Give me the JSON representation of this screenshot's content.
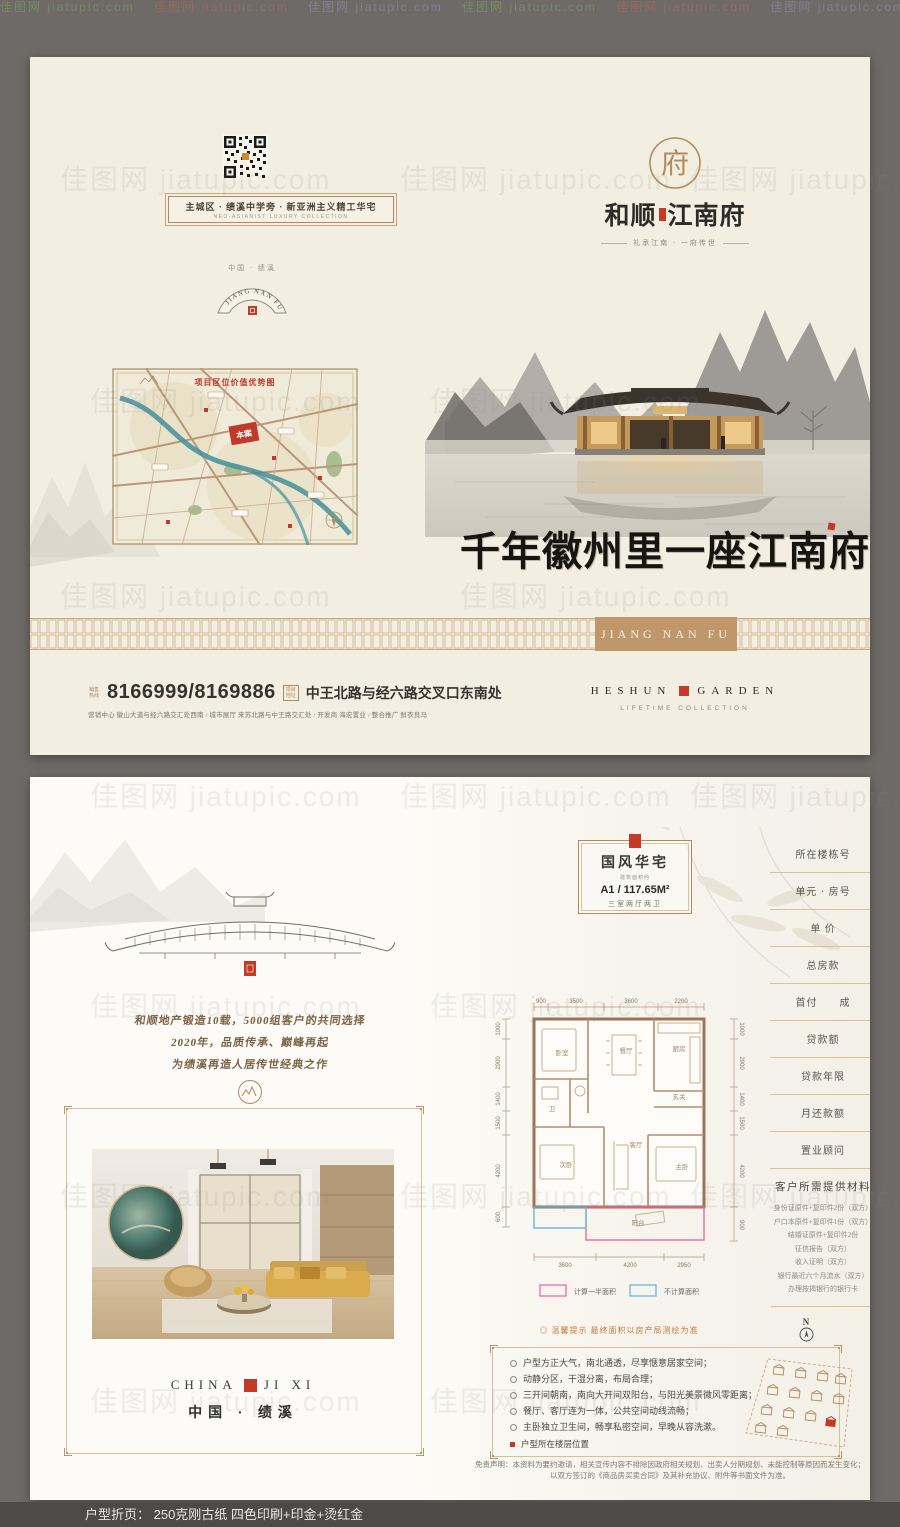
{
  "page": {
    "watermark": "佳图网 jiatupic.com",
    "watermark_row": "佳图网 jiatupic.com  佳图网 jiatupic.com  佳图网 jiatupic.com  佳图网 jiatupic.com  佳图网 jiatupic.com",
    "caption": "户型折页： 250克刚古纸   四色印刷+印金+烫红金"
  },
  "colors": {
    "accent_gold": "#b08a5f",
    "seal_red": "#c23a28",
    "band_tan": "#c0976b",
    "river_teal": "#43909b",
    "legend_pink": "#e8649a",
    "legend_blue": "#5ab4d8"
  },
  "cover": {
    "banner": {
      "title": "主城区 · 绩溪中学旁 · 新亚洲主义精工华宅",
      "subtitle": "NEO-ASIANIST LUXURY COLLECTION"
    },
    "country_label": "中国 · 绩溪",
    "fan_label": "JIANG NAN FU",
    "map": {
      "title": "项目区位价值优势图",
      "site_label": "本案"
    },
    "logo": {
      "name_left": "和顺",
      "name_right": "江南府",
      "tagline": "礼承江南 · 一府传世"
    },
    "calligraphy": "千年徽州里一座江南府",
    "band_label": "JIANG NAN FU",
    "contact": {
      "hotline_icon_text": "销售热线",
      "phones": "8166999/8169886",
      "address_icon_text": "项目地址",
      "address": "中王北路与经六路交叉口东南处",
      "agencies": "营销中心 徽山大道与经六路交汇处西南 / 城市展厅 来苏北路与中王路交汇处 / 开发商 海宏置业 / 整合推广 鲜衣良马"
    },
    "brand": {
      "en_left": "HESHUN",
      "en_right": "GARDEN",
      "subtitle": "LIFETIME COLLECTION"
    }
  },
  "inside": {
    "left": {
      "intro_lines": [
        "和顺地产锻造10载，5000组客户的共同选择",
        "2020年，品质传承、巅峰再起",
        "为绩溪再造人居传世经典之作"
      ],
      "china_en_left": "CHINA",
      "china_en_right": "JI XI",
      "china_cn": "中国 · 绩溪"
    },
    "right": {
      "unit_card": {
        "title": "国风华宅",
        "subtitle": "建筑面积约",
        "unit": "A1 / 117.65M²",
        "rooms": "三室两厅两卫"
      },
      "form_fields": [
        "所在楼栋号",
        "单元 · 房号",
        "单 价",
        "总房款",
        "首付　　成",
        "贷款额",
        "贷款年限",
        "月还款额",
        "置业顾问"
      ],
      "materials": {
        "title": "客户所需提供材料",
        "items": [
          "身份证原件+复印件2份（双方）",
          "户口本原件+复印件1份（双方）",
          "结婚证原件+复印件2份",
          "征信报告（双方）",
          "收入证明（双方）",
          "银行最近六个月流水（双方）",
          "办理按揭银行的银行卡"
        ]
      },
      "floorplan": {
        "dims_top": [
          "900",
          "3500",
          "3600",
          "2200"
        ],
        "dims_left": [
          "1000",
          "2900",
          "1400",
          "1500",
          "4200",
          "600"
        ],
        "dims_right": [
          "1000",
          "2900",
          "1400",
          "1500",
          "4200",
          "900"
        ],
        "dims_bottom": [
          "3600",
          "4200",
          "2950"
        ],
        "rooms": [
          "卧室",
          "餐厅",
          "厨房",
          "卫",
          "玄关",
          "客厅",
          "次卧",
          "主卧",
          "阳台"
        ],
        "legend_half": "计算一半面积",
        "legend_none": "不计算面积"
      },
      "tip": "◎ 温馨提示 最终面积以房产局测绘为准",
      "features": [
        "户型方正大气，南北通透，尽享惬意居家空间；",
        "动静分区，干湿分离，布局合理；",
        "三开间朝南，南向大开间双阳台，与阳光美景微风零距离；",
        "餐厅、客厅连为一体，公共空间动线流畅；",
        "主卧独立卫生间，畅享私密空间，早晚从容洗漱。"
      ],
      "floor_note": "户型所在楼层位置",
      "compass_label": "N",
      "disclaimer_line1": "免责声明：本资料为要约邀请，相关宣传内容不排除因政府相关规划、出卖人分期规划、未能控制等原因而发生变化；",
      "disclaimer_line2": "以双方签订的《商品房买卖合同》及其补充协议、附件等书面文件为准。"
    }
  }
}
